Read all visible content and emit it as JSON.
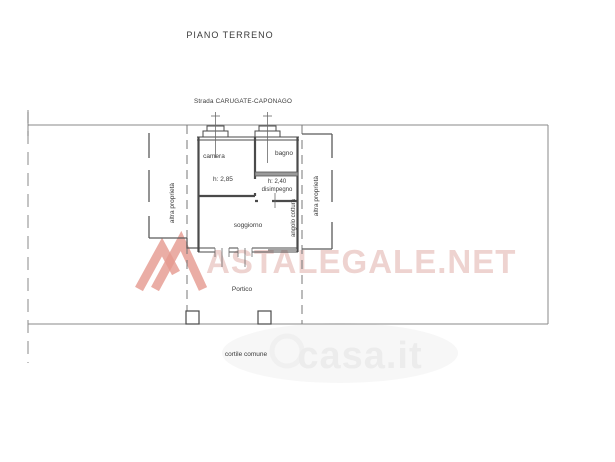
{
  "title": "PIANO TERRENO",
  "street_label": "Strada CARUGATE-CAPONAGO",
  "rooms": {
    "camera": {
      "label": "camera",
      "height": "h: 2,85"
    },
    "bagno": {
      "label": "bagno"
    },
    "disimpegno": {
      "label": "disimpegno",
      "height": "h: 2,40"
    },
    "soggiorno": {
      "label": "soggiorno"
    },
    "angolo_cottura": {
      "label": "angolo cottura"
    },
    "portico": {
      "label": "Portico"
    }
  },
  "boundaries": {
    "left_neighbor": "altra proprietà",
    "right_neighbor": "altra proprietà",
    "courtyard": "cortile comune"
  },
  "watermarks": {
    "astalegale": "ASTALEGALE.NET",
    "casa": "casa.it"
  },
  "colors": {
    "wall": "#4a4a4a",
    "boundary": "#8a8a8a",
    "text": "#3a3a3a",
    "wm-pink": "#eed3d0",
    "wm-logo": "#e5988f",
    "wm-gray": "#ececec",
    "bg": "#ffffff"
  }
}
